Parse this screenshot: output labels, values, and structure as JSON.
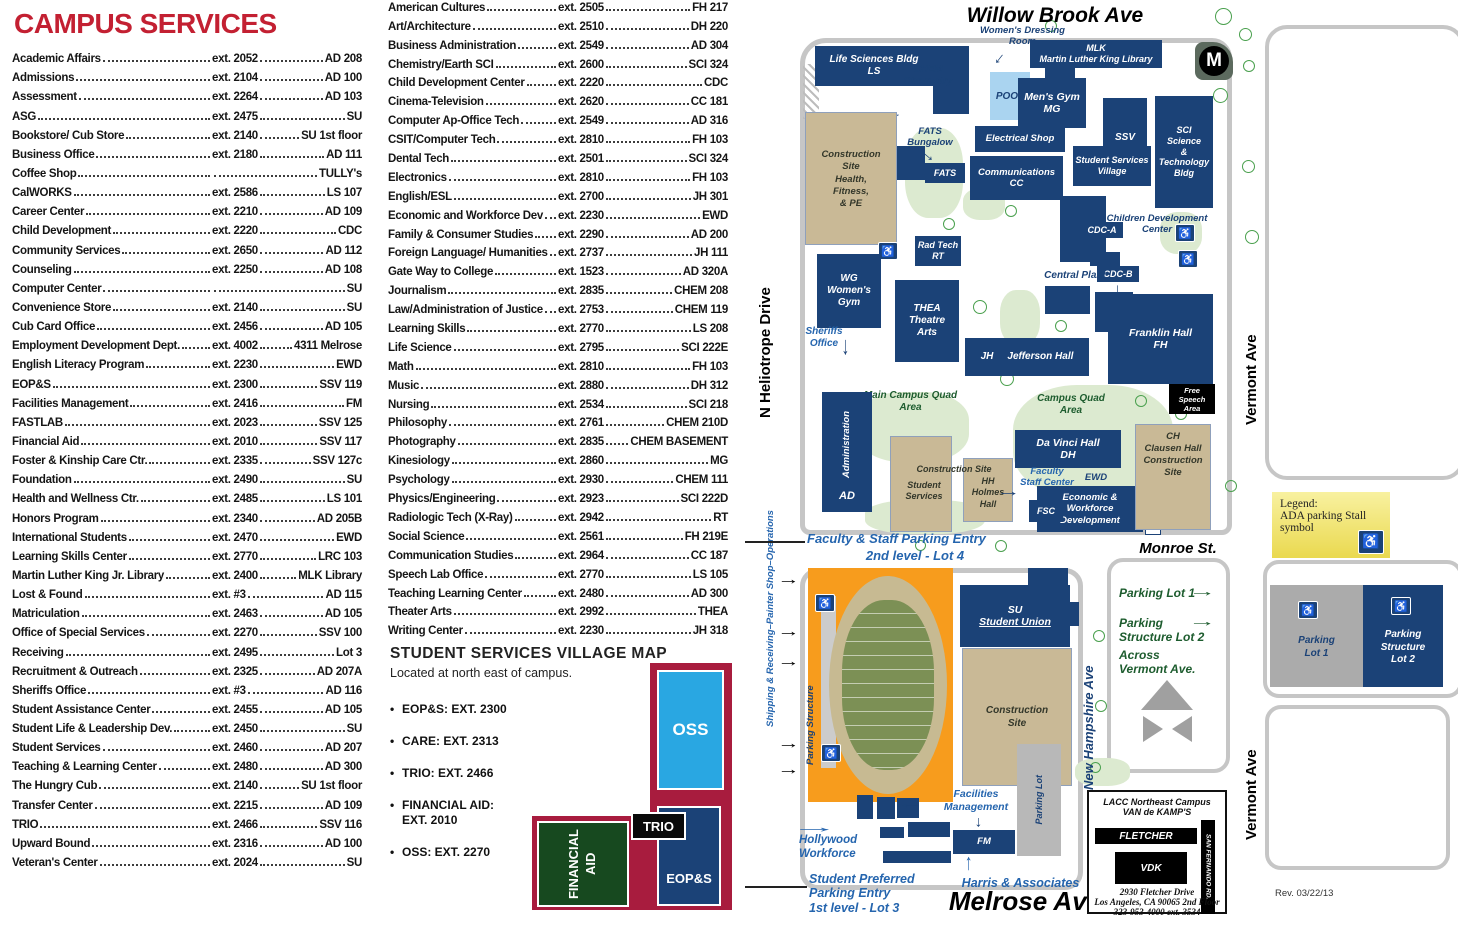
{
  "icons": {
    "ada": "♿",
    "arrow": "→",
    "bullet": "•"
  },
  "directory": {
    "title": "CAMPUS SERVICES",
    "left": [
      {
        "n": "Academic Affairs",
        "e": "ext. 2052",
        "l": "AD 208"
      },
      {
        "n": "Admissions",
        "e": "ext. 2104",
        "l": "AD 100"
      },
      {
        "n": "Assessment",
        "e": "ext. 2264",
        "l": "AD 103"
      },
      {
        "n": "ASG",
        "e": "ext. 2475",
        "l": "SU"
      },
      {
        "n": "Bookstore/ Cub Store",
        "e": "ext. 2140",
        "l": "SU 1st floor"
      },
      {
        "n": "Business Office",
        "e": "ext. 2180",
        "l": "AD 111"
      },
      {
        "n": "Coffee Shop",
        "e": "",
        "l": "TULLY's"
      },
      {
        "n": "CalWORKS",
        "e": "ext. 2586",
        "l": "LS 107"
      },
      {
        "n": "Career Center",
        "e": "ext. 2210",
        "l": "AD 109"
      },
      {
        "n": "Child Development",
        "e": "ext. 2220",
        "l": "CDC"
      },
      {
        "n": "Community Services",
        "e": "ext. 2650",
        "l": "AD 112"
      },
      {
        "n": "Counseling",
        "e": "ext. 2250",
        "l": "AD 108"
      },
      {
        "n": "Computer Center",
        "e": "",
        "l": "SU"
      },
      {
        "n": "Convenience Store",
        "e": "ext. 2140",
        "l": "SU"
      },
      {
        "n": "Cub Card Office",
        "e": "ext. 2456",
        "l": "AD 105"
      },
      {
        "n": "Employment Development Dept.",
        "e": "ext. 4002",
        "l": "4311 Melrose"
      },
      {
        "n": "English Literacy Program",
        "e": "ext. 2230",
        "l": "EWD"
      },
      {
        "n": "EOP&S",
        "e": "ext. 2300",
        "l": "SSV 119"
      },
      {
        "n": "Facilities Management",
        "e": "ext. 2416",
        "l": "FM"
      },
      {
        "n": "FASTLAB",
        "e": "ext. 2023",
        "l": "SSV 125"
      },
      {
        "n": "Financial Aid",
        "e": "ext. 2010",
        "l": "SSV 117"
      },
      {
        "n": "Foster & Kinship Care Ctr.",
        "e": "ext. 2335",
        "l": "SSV 127c"
      },
      {
        "n": "Foundation",
        "e": "ext. 2490",
        "l": "SU"
      },
      {
        "n": "Health and Wellness Ctr.",
        "e": "ext. 2485",
        "l": "LS 101"
      },
      {
        "n": "Honors Program",
        "e": "ext. 2340",
        "l": "AD 205B"
      },
      {
        "n": "International Students",
        "e": "ext. 2470",
        "l": "EWD"
      },
      {
        "n": "Learning Skills Center",
        "e": "ext. 2770",
        "l": "LRC 103"
      },
      {
        "n": "Martin Luther King Jr. Library",
        "e": "ext. 2400",
        "l": "MLK Library"
      },
      {
        "n": "Lost & Found",
        "e": "ext. #3",
        "l": "AD 115"
      },
      {
        "n": "Matriculation",
        "e": "ext. 2463",
        "l": "AD 105"
      },
      {
        "n": "Office of Special Services",
        "e": "ext. 2270",
        "l": "SSV 100"
      },
      {
        "n": "Receiving",
        "e": "ext. 2495",
        "l": "Lot 3"
      },
      {
        "n": "Recruitment & Outreach",
        "e": "ext. 2325",
        "l": "AD 207A"
      },
      {
        "n": "Sheriffs Office",
        "e": "ext. #3",
        "l": "AD 116"
      },
      {
        "n": "Student Assistance Center",
        "e": "ext. 2455",
        "l": "AD 105"
      },
      {
        "n": "Student Life & Leadership Dev.",
        "e": "ext. 2450",
        "l": "SU"
      },
      {
        "n": "Student Services",
        "e": "ext. 2460",
        "l": "AD 207"
      },
      {
        "n": "Teaching & Learning Center",
        "e": "ext. 2480",
        "l": "AD 300"
      },
      {
        "n": "The Hungry Cub",
        "e": "ext. 2140",
        "l": "SU 1st floor"
      },
      {
        "n": "Transfer Center",
        "e": "ext. 2215",
        "l": "AD 109"
      },
      {
        "n": "TRIO",
        "e": "ext. 2466",
        "l": "SSV 116"
      },
      {
        "n": "Upward Bound",
        "e": "ext. 2316",
        "l": "AD 100"
      },
      {
        "n": "Veteran's Center",
        "e": "ext. 2024",
        "l": "SU"
      }
    ],
    "middle": [
      {
        "n": "American Cultures",
        "e": "ext. 2505",
        "l": "FH 217"
      },
      {
        "n": "Art/Architecture",
        "e": "ext. 2510",
        "l": "DH 220"
      },
      {
        "n": "Business Administration",
        "e": "ext. 2549",
        "l": "AD 304"
      },
      {
        "n": "Chemistry/Earth SCI",
        "e": "ext. 2600",
        "l": "SCI 324"
      },
      {
        "n": "Child Development Center",
        "e": "ext. 2220",
        "l": "CDC"
      },
      {
        "n": "Cinema-Television",
        "e": "ext. 2620",
        "l": "CC 181"
      },
      {
        "n": "Computer Ap-Office Tech",
        "e": "ext. 2549",
        "l": "AD 316"
      },
      {
        "n": "CSIT/Computer Tech",
        "e": "ext. 2810",
        "l": "FH 103"
      },
      {
        "n": "Dental Tech",
        "e": "ext. 2501",
        "l": "SCI 324"
      },
      {
        "n": "Electronics",
        "e": "ext. 2810",
        "l": "FH 103"
      },
      {
        "n": "English/ESL",
        "e": "ext. 2700",
        "l": "JH 301"
      },
      {
        "n": "Economic and Workforce Dev",
        "e": "ext. 2230",
        "l": "EWD"
      },
      {
        "n": "Family & Consumer Studies",
        "e": "ext. 2290",
        "l": "AD 200"
      },
      {
        "n": "Foreign Language/ Humanities",
        "e": "ext. 2737",
        "l": "JH 111"
      },
      {
        "n": "Gate Way to College",
        "e": "ext. 1523",
        "l": "AD 320A"
      },
      {
        "n": "Journalism",
        "e": "ext. 2835",
        "l": "CHEM 208"
      },
      {
        "n": "Law/Administration of Justice",
        "e": "ext. 2753",
        "l": "CHEM 119"
      },
      {
        "n": "Learning Skills",
        "e": "ext. 2770",
        "l": "LS 208"
      },
      {
        "n": "Life Science",
        "e": "ext. 2795",
        "l": "SCI 222E"
      },
      {
        "n": "Math",
        "e": "ext. 2810",
        "l": "FH 103"
      },
      {
        "n": "Music",
        "e": "ext. 2880",
        "l": "DH 312"
      },
      {
        "n": "Nursing",
        "e": "ext. 2534",
        "l": "SCI 218"
      },
      {
        "n": "Philosophy",
        "e": "ext. 2761",
        "l": "CHEM 210D"
      },
      {
        "n": "Photography",
        "e": "ext. 2835",
        "l": "CHEM BASEMENT"
      },
      {
        "n": "Kinesiology",
        "e": "ext. 2860",
        "l": "MG"
      },
      {
        "n": "Psychology",
        "e": "ext. 2930",
        "l": "CHEM 111"
      },
      {
        "n": "Physics/Engineering",
        "e": "ext. 2923",
        "l": "SCI 222D"
      },
      {
        "n": "Radiologic Tech (X-Ray)",
        "e": "ext. 2942",
        "l": "RT"
      },
      {
        "n": "Social Science",
        "e": "ext. 2561",
        "l": "FH 219E"
      },
      {
        "n": "Communication Studies",
        "e": "ext. 2964",
        "l": "CC 187"
      },
      {
        "n": "Speech Lab Office",
        "e": "ext. 2770",
        "l": "LS 105"
      },
      {
        "n": "Teaching Learning Center",
        "e": "ext. 2480",
        "l": "AD 300"
      },
      {
        "n": "Theater Arts",
        "e": "ext. 2992",
        "l": "THEA"
      },
      {
        "n": "Writing Center",
        "e": "ext. 2230",
        "l": "JH 318"
      }
    ]
  },
  "ssv": {
    "title": "STUDENT SERVICES VILLAGE MAP",
    "subtitle": "Located at north east of campus.",
    "bullets": [
      {
        "t": "EOP&S: EXT. 2300"
      },
      {
        "t": "CARE: EXT. 2313"
      },
      {
        "t": "TRIO: EXT. 2466"
      },
      {
        "t": "FINANCIAL AID:\nEXT. 2010"
      },
      {
        "t": "OSS: EXT. 2270"
      }
    ],
    "inset": {
      "oss": "OSS",
      "trio": "TRIO",
      "eops": "EOP&S",
      "fa": "FINANCIAL\nAID"
    }
  },
  "map": {
    "streets": {
      "willow": "Willow Brook Ave",
      "heliotrope": "N Heliotrope Drive",
      "shipping": "Shipping & Receiving–Painter Shop–Operations",
      "vermont": "Vermont Ave",
      "monroe": "Monroe St.",
      "new_hampshire": "New Hampshire Ave",
      "melrose": "Melrose Ave"
    },
    "b": {
      "ls": "Life Sciences Bldg\nLS",
      "carpenter": "Carpenter\nshop",
      "chem": "CHEM\nChemistry",
      "dressing": "Women's Dressing\nRoom",
      "mlk": "MLK\nMartin Luther King Library",
      "metro": "M",
      "pool": "POOL",
      "mens_gym": "Men's Gym\nMG",
      "electrical": "Electrical Shop",
      "fats_label": "FATS\nBungalow",
      "fats": "FATS",
      "comms": "Communications\nCC",
      "constr_hfpe": "Construction\nSite\nHealth,\nFitness,\n& PE",
      "ssv_tower": "SSV",
      "ssv_lower": "Student Services\nVillage",
      "sci": "SCI\nScience\n&\nTechnology\nBldg",
      "children": "Children Development\nCenter",
      "cdca": "CDC-A",
      "cdcb": "CDC-B",
      "central_plant": "Central Plant",
      "rad": "Rad Tech\nRT",
      "wg": "WG\nWomen's\nGym",
      "thea": "THEA\nTheatre\nArts",
      "sheriffs": "Sheriffs\nOffice",
      "jh": "JH",
      "jefferson": "Jefferson Hall",
      "franklin": "Franklin Hall\nFH",
      "free_speech": "Free\nSpeech\nArea",
      "main_quad": "Main Campus Quad\nArea",
      "campus_quad": "Campus Quad\nArea",
      "admin_v": "Administration",
      "admin_ad": "AD",
      "constr_site": "Construction Site",
      "constr_ss": "Student\nServices",
      "hh": "HH\nHolmes\nHall",
      "davinci": "Da Vinci Hall\nDH",
      "fsc_label": "Faculty\nStaff Center",
      "fsc": "FSC",
      "ewd_tag": "EWD",
      "ewd": "Economic &\nWorkforce\nDevelopment",
      "tullys": "TULLY's",
      "clausen": "CH\nClausen Hall\nConstruction\nSite",
      "su": "SU",
      "su2": "Student Union",
      "constr2": "Construction\nSite",
      "parking_structure": "Parking Structure",
      "parking_lot_v": "Parking Lot",
      "fm": "FM",
      "facilities": "Facilities\nManagement",
      "hollywood": "Hollywood\nWorkforce",
      "harris": "Harris & Associates"
    },
    "labels": {
      "fsp1": "Faculty & Staff Parking Entry",
      "fsp2": "2nd level - Lot 4",
      "spp": "Student Preferred\nParking Entry\n1st level - Lot 3",
      "pl1": "Parking Lot 1",
      "pl2a": "Parking",
      "pl2b": "Structure Lot 2",
      "across": "Across\nVermont Ave."
    },
    "legend": {
      "l1": "Legend:",
      "l2": "ADA parking Stall",
      "l3": "symbol"
    },
    "parkbox": {
      "lot1": "Parking\nLot 1",
      "lot2": "Parking\nStructure\nLot 2"
    },
    "vdk": {
      "t1": "LACC Northeast Campus",
      "t2": "VAN de KAMP'S",
      "fletcher": "FLETCHER",
      "vdk": "VDK",
      "sanfernando": "SAN FERNANDO RD.",
      "a1": "2930 Fletcher Drive",
      "a2": "Los Angeles, CA 90065 2nd Floor",
      "a3": "323-953-4000  ext. 3534"
    },
    "rev": "Rev. 03/22/13"
  }
}
